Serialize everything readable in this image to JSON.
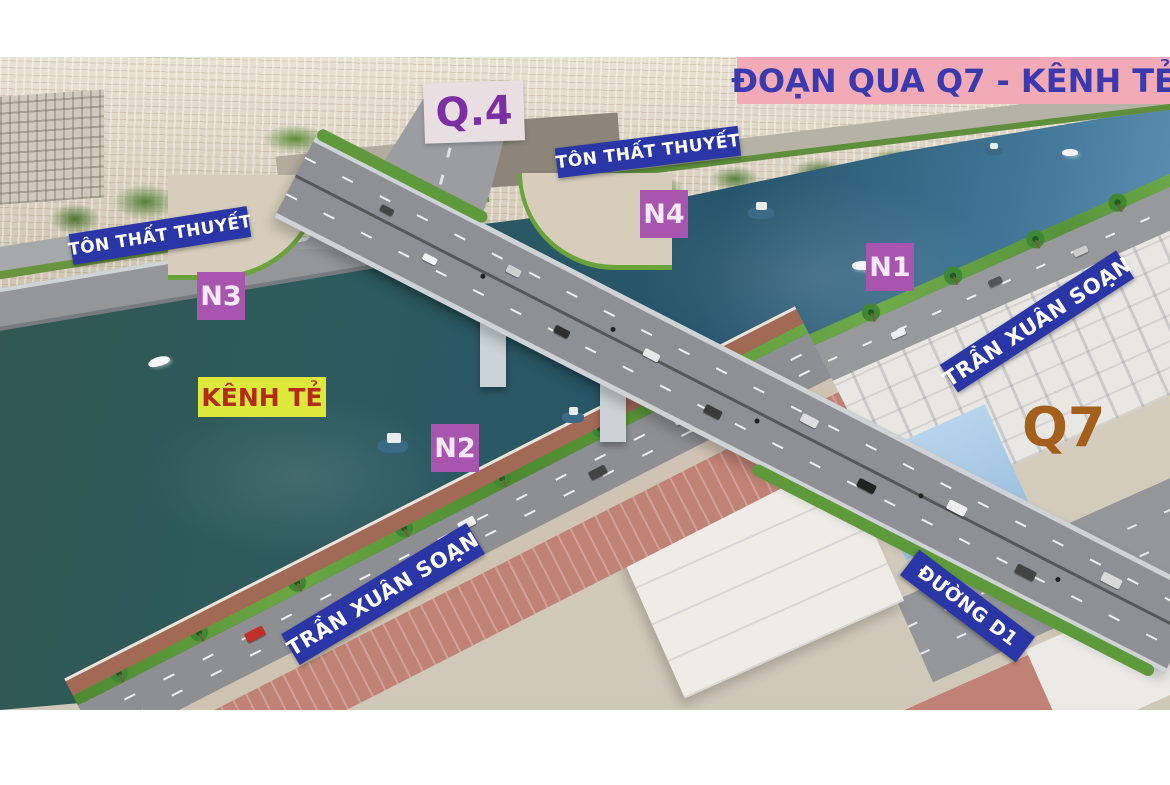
{
  "scene_title": {
    "text": "ĐOẠN QUA Q7 - KÊNH TẺ"
  },
  "area_labels": {
    "q4": "Q.4",
    "q7": "Q7",
    "canal": "KÊNH TẺ"
  },
  "road_labels": {
    "ton_that_thuyet_left": "TÔN THẤT THUYẾT",
    "ton_that_thuyet_top": "TÔN THẤT THUYẾT",
    "tran_xuan_soan_right": "TRẦN XUÂN SOẠN",
    "tran_xuan_soan_bottom": "TRẦN XUÂN SOẠN",
    "duong_d1": "ĐƯỜNG D1"
  },
  "node_markers": {
    "n1": "N1",
    "n2": "N2",
    "n3": "N3",
    "n4": "N4"
  },
  "colors": {
    "title_bg": "#f2aab6",
    "title_text": "#3a3aae",
    "road_sign_bg": "#2b36a6",
    "road_sign_text": "#ffffff",
    "node_bg": "#a855b0",
    "node_text": "#f6e8f8",
    "canal_label_bg": "#dce93a",
    "canal_label_text": "#b32b1b",
    "q4_text": "#7b2fa2",
    "q7_text": "#a2601c",
    "water_dark": "#2d5a57",
    "water_light": "#6d9cc0"
  }
}
